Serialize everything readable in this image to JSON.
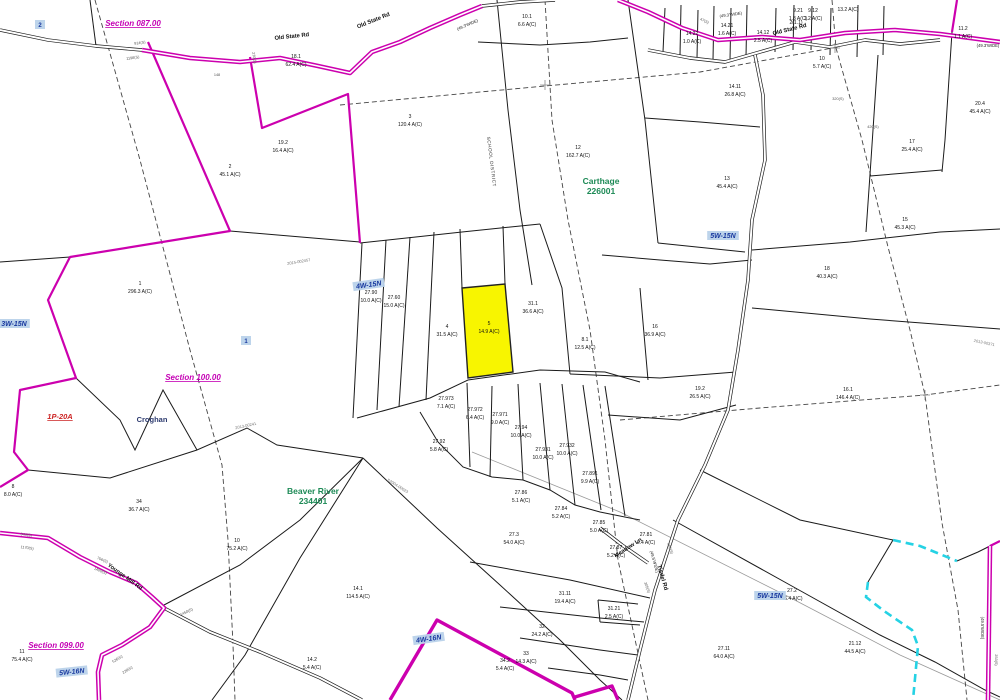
{
  "map": {
    "colors": {
      "magenta": "#cc00ae",
      "cyan": "#25d2e4",
      "highlight_yellow": "#f8f500",
      "section_label": "#c400b4",
      "sheet_ref_blue": "#17379e",
      "district_green": "#1d8a56",
      "deed_gray": "#777777"
    },
    "highlighted_parcel": {
      "id": "5",
      "acreage": "14.9 A(C)",
      "x": 489,
      "y": 327
    },
    "sections": [
      {
        "text": "Section 087.00",
        "x": 133,
        "y": 26,
        "rot": 0
      },
      {
        "text": "Section 100.00",
        "x": 193,
        "y": 380,
        "rot": 0
      },
      {
        "text": "Section 099.00",
        "x": 56,
        "y": 648,
        "rot": 0
      }
    ],
    "sheet_refs": [
      {
        "text": "3W-15N",
        "x": 14,
        "y": 326,
        "rot": 0
      },
      {
        "text": "4W-15N",
        "x": 369,
        "y": 287,
        "rot": -8
      },
      {
        "text": "5W-15N",
        "x": 723,
        "y": 238,
        "rot": 0
      },
      {
        "text": "5W-15N",
        "x": 770,
        "y": 598,
        "rot": 0
      },
      {
        "text": "5W-16N",
        "x": 72,
        "y": 674,
        "rot": -6
      },
      {
        "text": "4W-16N",
        "x": 429,
        "y": 641,
        "rot": -8
      }
    ],
    "markers": [
      {
        "text": "2",
        "x": 40,
        "y": 27
      },
      {
        "text": "1",
        "x": 246,
        "y": 343
      }
    ],
    "districts": [
      {
        "name": "Carthage",
        "code": "226001",
        "x": 601,
        "y": 184
      },
      {
        "name": "Beaver River",
        "code": "234401",
        "x": 313,
        "y": 494
      }
    ],
    "places": [
      {
        "text": "Croghan",
        "x": 152,
        "y": 422
      }
    ],
    "red_refs": [
      {
        "text": "1P-20A",
        "x": 60,
        "y": 419
      }
    ],
    "school_district": {
      "text": "SCHOOL DISTRICT",
      "x": 490,
      "y": 162,
      "rot": 83
    },
    "roads": [
      {
        "text": "Old State Rd",
        "x": 292,
        "y": 38,
        "rot": -6
      },
      {
        "text": "Old State Rd",
        "x": 374,
        "y": 22,
        "rot": -22
      },
      {
        "text": "Old State Rd",
        "x": 790,
        "y": 31,
        "rot": -14
      },
      {
        "text": "Younge Mill Rd",
        "x": 124,
        "y": 578,
        "rot": 36
      },
      {
        "text": "Tisdel Rd",
        "x": 661,
        "y": 578,
        "rot": 74
      },
      {
        "text": "Meadow Ln",
        "x": 629,
        "y": 549,
        "rot": -33
      }
    ],
    "road_widths": [
      {
        "text": "(49.3'WIDE)",
        "x": 468,
        "y": 26,
        "rot": -24
      },
      {
        "text": "(49.3'WIDE)",
        "x": 731,
        "y": 16,
        "rot": -8
      },
      {
        "text": "(49.3'WIDE)",
        "x": 988,
        "y": 47,
        "rot": 0
      },
      {
        "text": "(49.5'WIDE)",
        "x": 653,
        "y": 562,
        "rot": 74
      },
      {
        "text": "(49.5'WIDE)",
        "x": 981,
        "y": 628,
        "rot": 90
      }
    ],
    "distances": [
      {
        "text": "914(S)",
        "x": 140,
        "y": 44,
        "rot": -8
      },
      {
        "text": "1198(S)",
        "x": 133,
        "y": 59,
        "rot": -8
      },
      {
        "text": "148",
        "x": 217,
        "y": 76,
        "rot": 0
      },
      {
        "text": "270(S)",
        "x": 253,
        "y": 58,
        "rot": 80
      },
      {
        "text": "47(S)",
        "x": 704,
        "y": 22,
        "rot": 25
      },
      {
        "text": "320(S)",
        "x": 838,
        "y": 100,
        "rot": 0
      },
      {
        "text": "420(S)",
        "x": 873,
        "y": 128,
        "rot": 0
      },
      {
        "text": "944(S)",
        "x": 26,
        "y": 536,
        "rot": 8
      },
      {
        "text": "1170(S)",
        "x": 27,
        "y": 549,
        "rot": 8
      },
      {
        "text": "706(S)",
        "x": 102,
        "y": 561,
        "rot": 22
      },
      {
        "text": "1400(S)",
        "x": 100,
        "y": 572,
        "rot": 22
      },
      {
        "text": "1450(S)",
        "x": 187,
        "y": 613,
        "rot": -25
      },
      {
        "text": "526(S)",
        "x": 118,
        "y": 660,
        "rot": -32
      },
      {
        "text": "228(S)",
        "x": 128,
        "y": 671,
        "rot": -32
      },
      {
        "text": "466(S)",
        "x": 669,
        "y": 549,
        "rot": 70
      },
      {
        "text": "305(S)",
        "x": 646,
        "y": 588,
        "rot": 70
      },
      {
        "text": "253(S)",
        "x": 995,
        "y": 660,
        "rot": 90
      }
    ],
    "deed_refs": [
      {
        "text": "2015-002457",
        "x": 299,
        "y": 263,
        "rot": -10
      },
      {
        "text": "2013-00241",
        "x": 246,
        "y": 427,
        "rot": -12
      },
      {
        "text": "S2004-00023",
        "x": 397,
        "y": 487,
        "rot": 32
      },
      {
        "text": "2013-00371",
        "x": 984,
        "y": 344,
        "rot": 12
      }
    ],
    "parcels": [
      {
        "id": "1",
        "ac": "296.3 A(C)",
        "x": 140,
        "y": 287
      },
      {
        "id": "2",
        "ac": "45.1 A(C)",
        "x": 230,
        "y": 170
      },
      {
        "id": "19.2",
        "ac": "16.4 A(C)",
        "x": 283,
        "y": 146
      },
      {
        "id": "18.1",
        "ac": "62.4 A(C)",
        "x": 296,
        "y": 60
      },
      {
        "id": "3",
        "ac": "120.4 A(C)",
        "x": 410,
        "y": 120
      },
      {
        "id": "10.1",
        "ac": "6.6 A(C)",
        "x": 527,
        "y": 20
      },
      {
        "id": "14.22",
        "ac": "1.0 A(C)",
        "x": 692,
        "y": 37
      },
      {
        "id": "14.21",
        "ac": "1.6 A(C)",
        "x": 727,
        "y": 29
      },
      {
        "id": "14.12",
        "ac": "2.5 A(C)",
        "x": 763,
        "y": 36
      },
      {
        "id": "9.21",
        "ac": "1.8 A(C)",
        "x": 798,
        "y": 14
      },
      {
        "id": "9.12",
        "ac": "1.2 A(C)",
        "x": 813,
        "y": 14
      },
      {
        "id": "",
        "ac": "13.2 A(C)",
        "x": 848,
        "y": 9
      },
      {
        "id": "2(1.1)",
        "ac": "",
        "x": 796,
        "y": 26
      },
      {
        "id": "11.2",
        "ac": "1.1 A(C)",
        "x": 963,
        "y": 32
      },
      {
        "id": "20.4",
        "ac": "45.4 A(C)",
        "x": 980,
        "y": 107
      },
      {
        "id": "17",
        "ac": "25.4 A(C)",
        "x": 912,
        "y": 145
      },
      {
        "id": "15",
        "ac": "45.3 A(C)",
        "x": 905,
        "y": 223
      },
      {
        "id": "14.11",
        "ac": "26.8 A(C)",
        "x": 735,
        "y": 90
      },
      {
        "id": "10",
        "ac": "5.7 A(C)",
        "x": 822,
        "y": 62
      },
      {
        "id": "12",
        "ac": "162.7 A(C)",
        "x": 578,
        "y": 151
      },
      {
        "id": "13",
        "ac": "45.4 A(C)",
        "x": 727,
        "y": 182
      },
      {
        "id": "18",
        "ac": "40.3 A(C)",
        "x": 827,
        "y": 272
      },
      {
        "id": "16.1",
        "ac": "146.4 A(C)",
        "x": 848,
        "y": 393
      },
      {
        "id": "19.2",
        "ac": "26.5 A(C)",
        "x": 700,
        "y": 392
      },
      {
        "id": "16",
        "ac": "36.9 A(C)",
        "x": 655,
        "y": 330
      },
      {
        "id": "8.1",
        "ac": "12.5 A(C)",
        "x": 585,
        "y": 343
      },
      {
        "id": "31.1",
        "ac": "36.6 A(C)",
        "x": 533,
        "y": 307
      },
      {
        "id": "4",
        "ac": "31.5 A(C)",
        "x": 447,
        "y": 330
      },
      {
        "id": "27.90",
        "ac": "10.0 A(C)",
        "x": 371,
        "y": 296
      },
      {
        "id": "27.60",
        "ac": "15.0 A(C)",
        "x": 394,
        "y": 301
      },
      {
        "id": "27.973",
        "ac": "7.1 A(C)",
        "x": 446,
        "y": 402
      },
      {
        "id": "27.972",
        "ac": "6.4 A(C)",
        "x": 475,
        "y": 413
      },
      {
        "id": "27.971",
        "ac": "9.0 A(C)",
        "x": 500,
        "y": 418
      },
      {
        "id": "27.94",
        "ac": "10.0 A(C)",
        "x": 521,
        "y": 431
      },
      {
        "id": "27.931",
        "ac": "10.0 A(C)",
        "x": 543,
        "y": 453
      },
      {
        "id": "27.932",
        "ac": "10.0 A(C)",
        "x": 567,
        "y": 449
      },
      {
        "id": "27.891",
        "ac": "9.9 A(C)",
        "x": 590,
        "y": 477
      },
      {
        "id": "27.92",
        "ac": "5.8 A(C)",
        "x": 439,
        "y": 445
      },
      {
        "id": "27.86",
        "ac": "5.1 A(C)",
        "x": 521,
        "y": 496
      },
      {
        "id": "27.84",
        "ac": "5.2 A(C)",
        "x": 561,
        "y": 512
      },
      {
        "id": "27.85",
        "ac": "5.0 A(C)",
        "x": 599,
        "y": 526
      },
      {
        "id": "27.87",
        "ac": "5.2 A(C)",
        "x": 616,
        "y": 551
      },
      {
        "id": "27.81",
        "ac": "6.4 A(C)",
        "x": 646,
        "y": 538
      },
      {
        "id": "27.3",
        "ac": "54.0 A(C)",
        "x": 514,
        "y": 538
      },
      {
        "id": "14.1",
        "ac": "114.5 A(C)",
        "x": 358,
        "y": 592
      },
      {
        "id": "34",
        "ac": "36.7 A(C)",
        "x": 139,
        "y": 505
      },
      {
        "id": "10",
        "ac": "75.2 A(C)",
        "x": 237,
        "y": 544
      },
      {
        "id": "11",
        "ac": "75.4 A(C)",
        "x": 22,
        "y": 655
      },
      {
        "id": "8",
        "ac": "8.0 A(C)",
        "x": 13,
        "y": 490
      },
      {
        "id": "31.11",
        "ac": "19.4 A(C)",
        "x": 565,
        "y": 597
      },
      {
        "id": "31.21",
        "ac": "2.5 A(C)",
        "x": 614,
        "y": 612
      },
      {
        "id": "32",
        "ac": "24.2 A(C)",
        "x": 542,
        "y": 630
      },
      {
        "id": "33",
        "ac": "14.3 A(C)",
        "x": 526,
        "y": 657
      },
      {
        "id": "34.2",
        "ac": "5.4 A(C)",
        "x": 505,
        "y": 664
      },
      {
        "id": "14.2",
        "ac": "5.4 A(C)",
        "x": 312,
        "y": 663
      },
      {
        "id": "27.11",
        "ac": "64.0 A(C)",
        "x": 724,
        "y": 652
      },
      {
        "id": "27.2",
        "ac": "46.4 A(C)",
        "x": 792,
        "y": 594
      },
      {
        "id": "21.12",
        "ac": "44.5 A(C)",
        "x": 855,
        "y": 647
      }
    ],
    "crosses": [
      {
        "x": 545,
        "y": 85
      },
      {
        "x": 835,
        "y": 48
      },
      {
        "x": 925,
        "y": 395
      }
    ]
  }
}
